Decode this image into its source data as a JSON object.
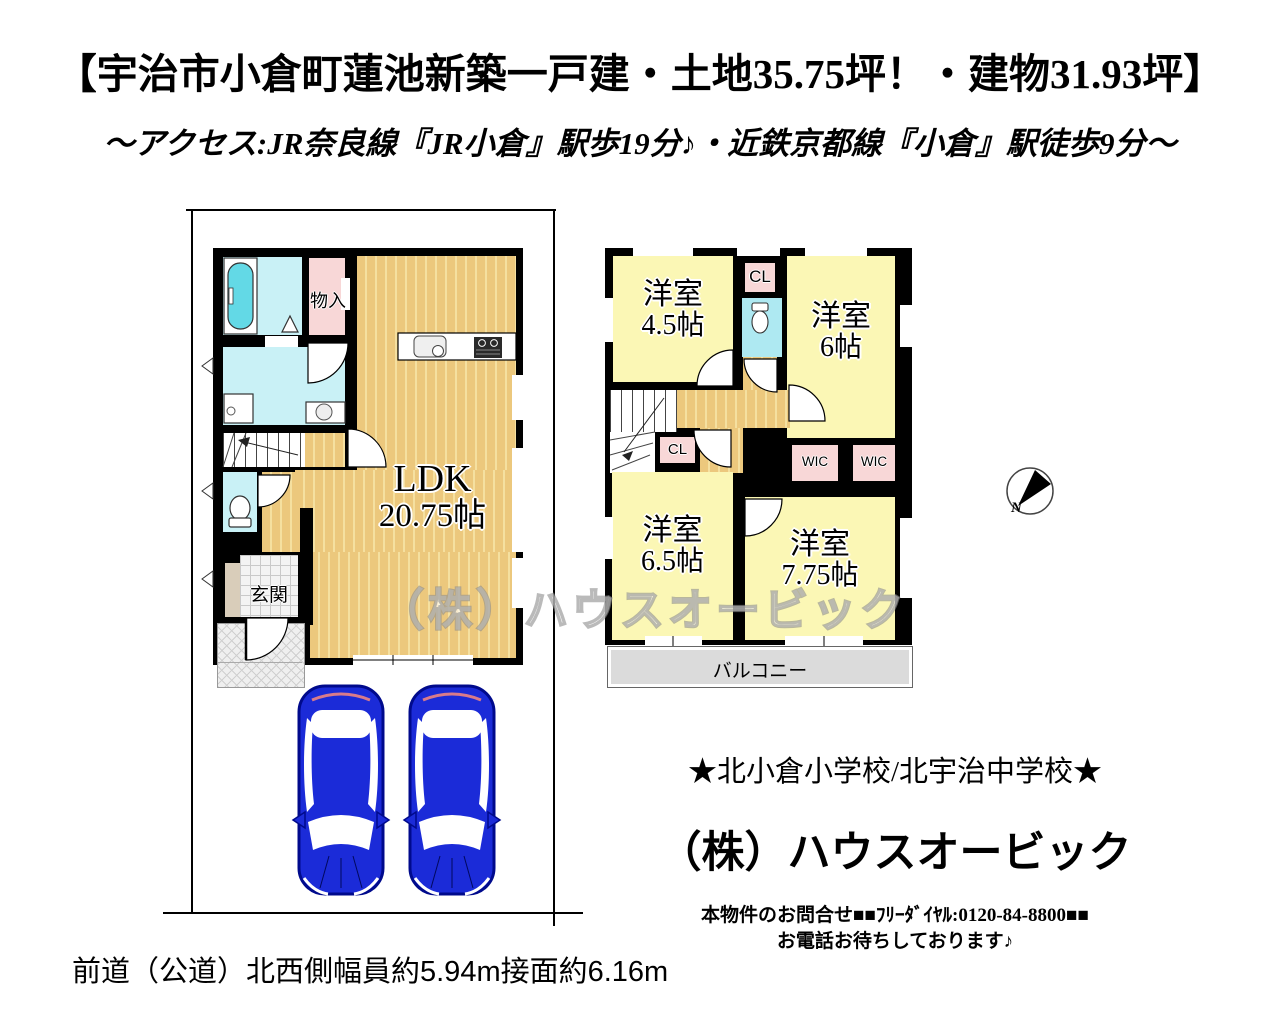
{
  "header": {
    "title": "【宇治市小倉町蓮池新築一戸建・土地35.75坪！・建物31.93坪】",
    "access": "～アクセス:JR奈良線『JR小倉』駅歩19分♪・近鉄京都線『小倉』駅徒歩9分～"
  },
  "floor1": {
    "ldk_name": "LDK",
    "ldk_size": "20.75帖",
    "entrance_label": "玄関",
    "storage_label": "物入"
  },
  "floor2": {
    "room_nw_name": "洋室",
    "room_nw_size": "4.5帖",
    "room_ne_name": "洋室",
    "room_ne_size": "6帖",
    "room_sw_name": "洋室",
    "room_sw_size": "6.5帖",
    "room_se_name": "洋室",
    "room_se_size": "7.75帖",
    "closet_top_label": "CL",
    "closet_mid_label": "CL",
    "wic_left_label": "WIC",
    "wic_right_label": "WIC",
    "balcony_label": "バルコニー"
  },
  "compass": {
    "north_label": "N"
  },
  "watermark_text": "（株）ハウスオービック",
  "footer": {
    "schools": "★北小倉小学校/北宇治中学校★",
    "company": "（株）ハウスオービック",
    "contact_line1": "本物件のお問合せ■■ﾌﾘｰﾀﾞｲﾔﾙ:0120-84-8800■■",
    "contact_line2": "お電話お待ちしております♪",
    "road_info": "前道（公道）北西側幅員約5.94m接面約6.16m"
  },
  "colors": {
    "wood_floor": "#ECC87D",
    "room_yellow": "#FBF7B5",
    "closet_pink": "#F8D7D7",
    "wet_area_cyan": "#C9F1F6",
    "bathtub_cyan": "#63D9E6",
    "balcony_gray": "#DCDCDC",
    "car_blue": "#1B2BD8"
  }
}
